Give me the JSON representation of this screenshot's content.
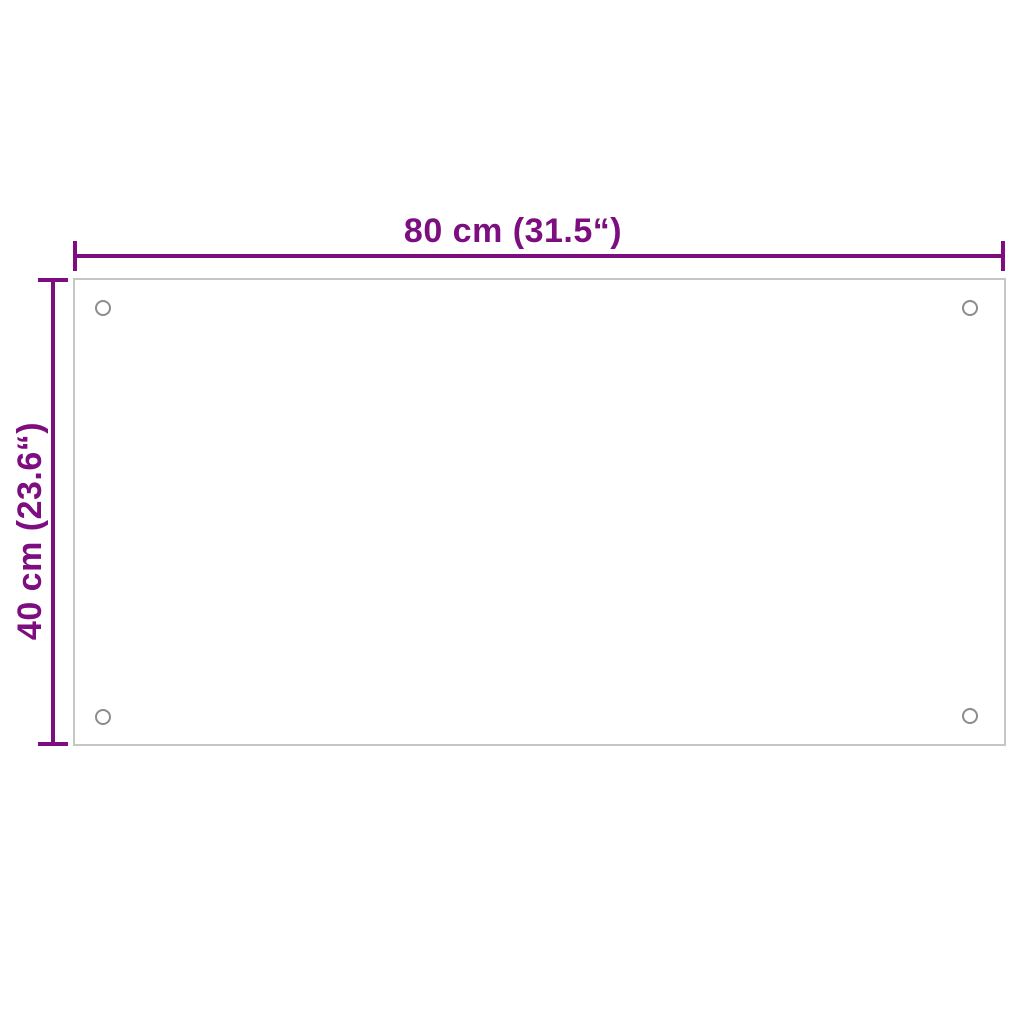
{
  "diagram": {
    "width_dimension": {
      "label": "80 cm (31.5“)"
    },
    "height_dimension": {
      "label": "40 cm (23.6“)"
    },
    "panel": {
      "mounting_holes": 4
    },
    "colors": {
      "annotation_purple": "#7C0E80",
      "panel_border_gray": "#C6C6C6",
      "mounting_hole_gray": "#8C8C8C",
      "background": "#FFFFFF"
    }
  }
}
